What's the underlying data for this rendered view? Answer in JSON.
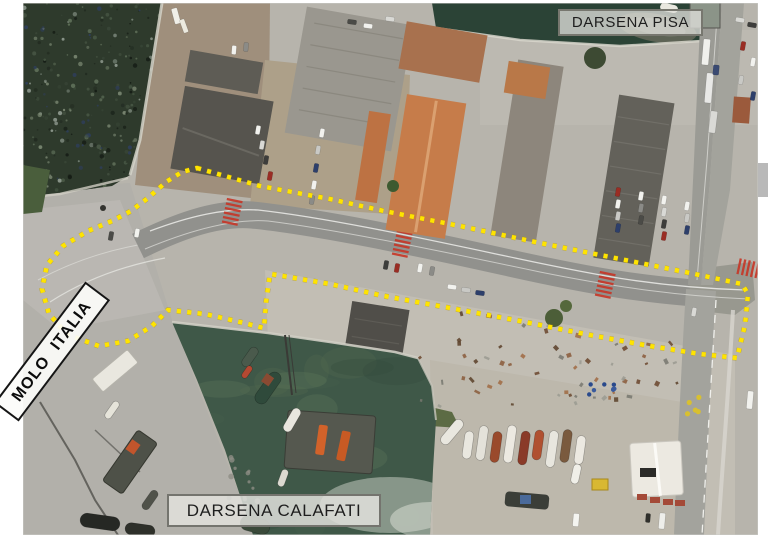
{
  "labels": {
    "darsena_pisa": "DARSENA PISA",
    "darsena_calafati": "DARSENA CALAFATI",
    "molo_italia": "MOLO ITALIA"
  },
  "annotation_outline": {
    "color": "#ffe400",
    "underlay_color": "#b39200",
    "style": "dotted",
    "points": [
      [
        197,
        168
      ],
      [
        260,
        186
      ],
      [
        330,
        199
      ],
      [
        384,
        211
      ],
      [
        460,
        226
      ],
      [
        540,
        243
      ],
      [
        620,
        259
      ],
      [
        690,
        273
      ],
      [
        742,
        284
      ],
      [
        748,
        294
      ],
      [
        745,
        325
      ],
      [
        737,
        358
      ],
      [
        700,
        354
      ],
      [
        650,
        346
      ],
      [
        590,
        335
      ],
      [
        520,
        321
      ],
      [
        450,
        308
      ],
      [
        384,
        296
      ],
      [
        330,
        284
      ],
      [
        283,
        276
      ],
      [
        270,
        274
      ],
      [
        266,
        302
      ],
      [
        264,
        328
      ],
      [
        240,
        322
      ],
      [
        205,
        314
      ],
      [
        168,
        310
      ],
      [
        152,
        326
      ],
      [
        128,
        341
      ],
      [
        99,
        346
      ],
      [
        68,
        335
      ],
      [
        49,
        314
      ],
      [
        42,
        289
      ],
      [
        47,
        265
      ],
      [
        63,
        246
      ],
      [
        88,
        231
      ],
      [
        112,
        221
      ],
      [
        131,
        211
      ],
      [
        148,
        198
      ],
      [
        166,
        182
      ],
      [
        182,
        172
      ]
    ]
  },
  "label_style_colors": {
    "pisa_calafati_fill": "#dfdfda",
    "pisa_calafati_border": "#74746e",
    "molo_fill": "#fcfcfa",
    "molo_border": "#151515"
  },
  "scrollbar": {
    "thumb_color": "#b9b9b9"
  },
  "scene_colors": {
    "page_margin": "#ffffff",
    "sea": "#2e3a2c",
    "pisa_water": "#2b4336",
    "basin_water": "#3f5848",
    "concrete": "#b7b4ac",
    "asphalt": "#91918d",
    "orange_roof": "#c67c4a",
    "dark_roof": "#56544e",
    "crosswalk_red": "#c63526"
  }
}
